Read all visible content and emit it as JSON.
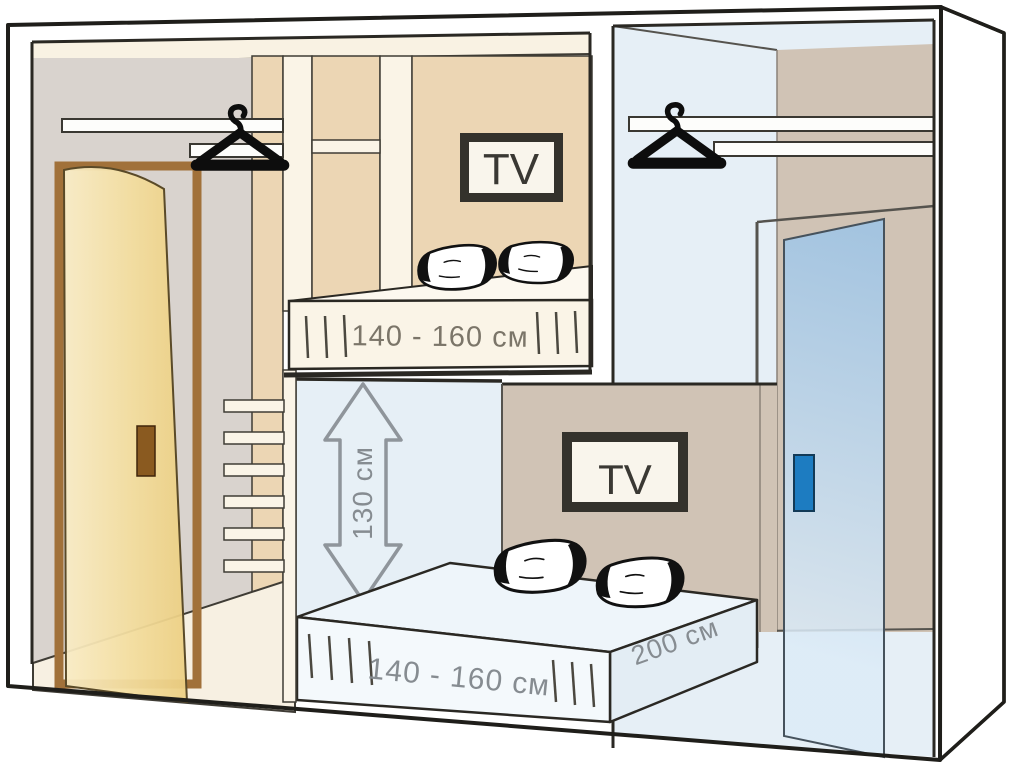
{
  "diagram": {
    "kind": "compact bedroom loft-bed layout scheme",
    "upper_room": {
      "tv_label": "TV",
      "bed_width_label": "140 - 160 см"
    },
    "lower_room": {
      "tv_label": "TV",
      "bed_width_label": "140 - 160 см",
      "bed_length_label": "200 см",
      "clearance_label": "130 см"
    },
    "icons": [
      "clothes-hanger-icon (left closet)",
      "clothes-hanger-icon (right closet)",
      "double-headed-height-arrow-icon",
      "ladder-rungs",
      "pillow (x4)"
    ],
    "colors": {
      "outline": "#2a2823",
      "wall_gray": "#d9d3ce",
      "wall_tan": "#ecd6b4",
      "wall_taupe": "#d0c3b5",
      "wall_lightblue": "#e6eff6",
      "cream": "#f8f1e3",
      "entry_door": "#f2d892",
      "entry_door_frame": "#a1713a",
      "entry_door_handle": "#8a5a20",
      "wardrobe_door": "#aecfeb",
      "wardrobe_door_handle": "#1d7cc1",
      "dimension_text_warm": "#7b7569",
      "dimension_text_cool": "#868c91",
      "tv_frame": "#34322c"
    }
  }
}
